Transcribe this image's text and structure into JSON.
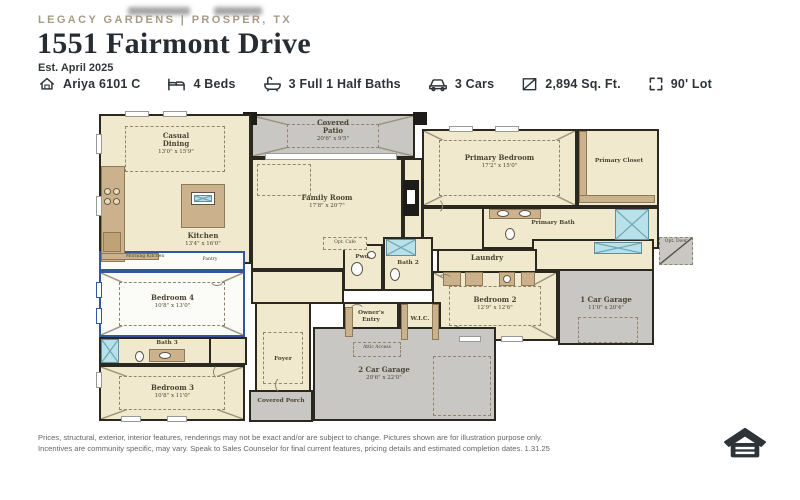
{
  "header": {
    "community": "LEGACY GARDENS | PROSPER, TX",
    "address": "1551 Fairmont Drive",
    "est": "Est. April 2025"
  },
  "specs": {
    "items": [
      {
        "icon": "house-icon",
        "label": "Ariya 6101 C"
      },
      {
        "icon": "bed-icon",
        "label": "4 Beds"
      },
      {
        "icon": "bath-icon",
        "label": "3 Full 1 Half Baths"
      },
      {
        "icon": "car-icon",
        "label": "3 Cars"
      },
      {
        "icon": "area-icon",
        "label": "2,894 Sq. Ft."
      },
      {
        "icon": "lot-icon",
        "label": "90' Lot"
      }
    ]
  },
  "floorplan": {
    "rooms": {
      "casual_dining": {
        "name": "Casual Dining",
        "dims": "13'0\" x 15'9\""
      },
      "covered_patio": {
        "name": "Covered Patio",
        "dims": "20'6\" x 9'5\""
      },
      "family_room": {
        "name": "Family Room",
        "dims": "17'8\" x 20'7\""
      },
      "kitchen": {
        "name": "Kitchen",
        "dims": "13'4\" x 16'0\""
      },
      "primary_bedroom": {
        "name": "Primary Bedroom",
        "dims": "17'2\" x 15'0\""
      },
      "primary_closet": {
        "name": "Primary Closet"
      },
      "primary_bath": {
        "name": "Primary Bath"
      },
      "laundry": {
        "name": "Laundry"
      },
      "powder": {
        "name": "Pwd."
      },
      "bath2": {
        "name": "Bath 2"
      },
      "bedroom2": {
        "name": "Bedroom 2",
        "dims": "12'9\" x 12'6\""
      },
      "morning_kitchen": {
        "name": "Morning Kitchen"
      },
      "pantry": {
        "name": "Pantry"
      },
      "bedroom4": {
        "name": "Bedroom 4",
        "dims": "10'8\" x 13'0\""
      },
      "bath3": {
        "name": "Bath 3"
      },
      "bedroom3": {
        "name": "Bedroom 3",
        "dims": "10'8\" x 11'0\""
      },
      "foyer": {
        "name": "Foyer"
      },
      "owners_entry": {
        "name": "Owner's Entry"
      },
      "wic": {
        "name": "W.I.C."
      },
      "garage2": {
        "name": "2 Car Garage",
        "dims": "20'6\" x 22'0\""
      },
      "garage1": {
        "name": "1 Car Garage",
        "dims": "11'0\" x 20'4\""
      },
      "covered_porch": {
        "name": "Covered Porch"
      }
    },
    "notes": {
      "attic": "Attic Access",
      "opt_door": "Opt. Door",
      "opt_cafe": "Opt. Cafe"
    }
  },
  "footer": {
    "line1": "Prices, structural, exterior, interior features, renderings may not be exact and/or are subject to change. Pictures shown are for illustration purpose only.",
    "line2": "Incentives are community specific, may vary. Speak to Sales Counselor for final current features, pricing details and estimated completion dates. 1.31.25"
  },
  "colors": {
    "accent_gold": "#a89b85",
    "ink": "#2e3338",
    "floor_cream": "#f1e9ce",
    "hardscape_gray": "#c8c7c3",
    "cabinet_tan": "#cbb28c",
    "highlight_blue": "#3456a0",
    "tile_blue": "#b9e1e9"
  }
}
